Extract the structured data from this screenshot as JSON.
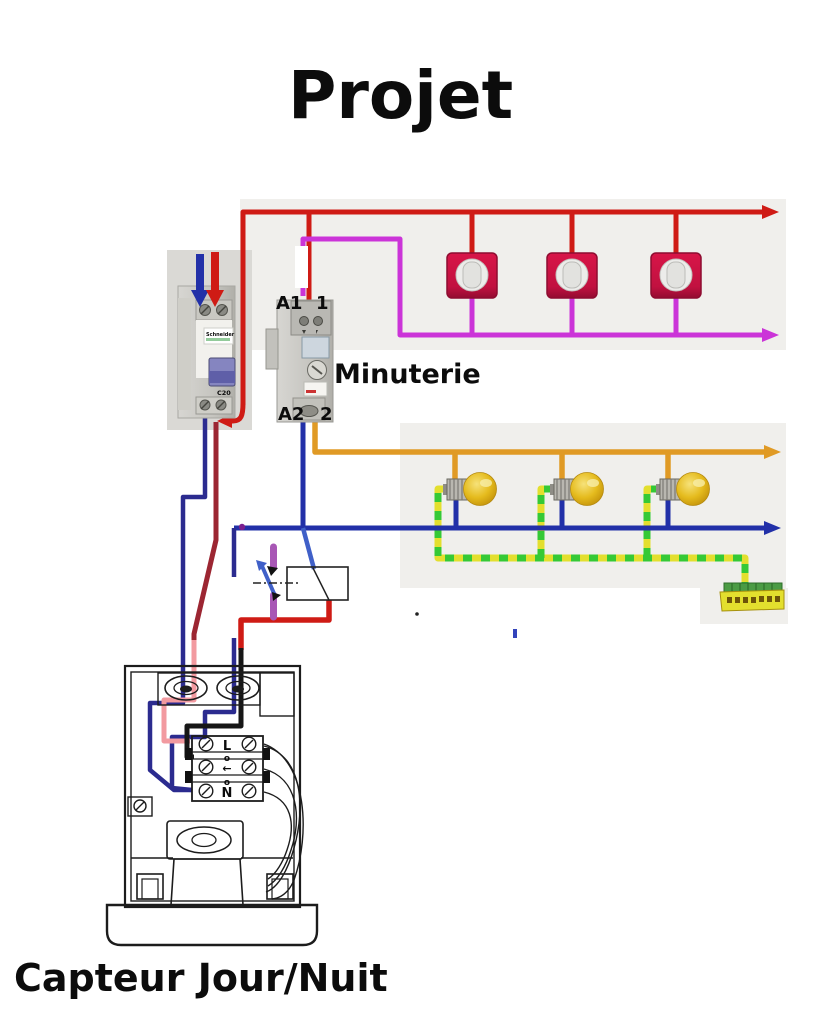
{
  "title": "Projet",
  "labels": {
    "timer_name": "Minuterie",
    "timer_a1": "A1",
    "timer_1": "1",
    "timer_a2": "A2",
    "timer_2": "2",
    "sensor_name": "Capteur Jour/Nuit",
    "terminal_live": "L",
    "terminal_neutral": "N",
    "terminal_o": "o",
    "terminal_arrow": "←",
    "breaker_brand": "Schneider",
    "breaker_rating": "C20"
  },
  "colors": {
    "phase_red": "#cf1b15",
    "return_magenta": "#cb34d8",
    "lamp_orange": "#e09a25",
    "neutral_blue": "#2230a8",
    "sensor_navy": "#2b2b8f",
    "sensor_pink": "#f29aa0",
    "dark_red": "#9c2632",
    "earth_yellow": "#e3df2e",
    "earth_green": "#35c935",
    "switch_purple": "#a857b5",
    "lever_blue": "#4060c8",
    "button_crimson": "#d6134a",
    "bulb_gold": "#e5bb1d",
    "canvas_gray": "#f0efec",
    "photo_gray": "#dad9d5",
    "junction_purple": "#7b1f8f"
  },
  "counts": {
    "push_buttons": 3,
    "lamps": 3
  }
}
